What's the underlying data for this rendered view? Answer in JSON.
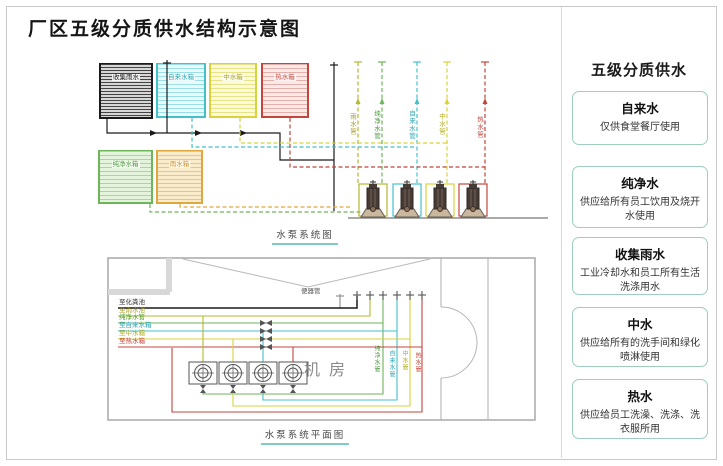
{
  "title": "厂区五级分质供水结构示意图",
  "system_diagram": {
    "caption": "水泵系统图",
    "tanks": [
      {
        "label": "收集雨水",
        "color": "#222222"
      },
      {
        "label": "自来水箱",
        "color": "#45c0cb"
      },
      {
        "label": "中水箱",
        "color": "#d9d23c"
      },
      {
        "label": "热水箱",
        "color": "#c4453c"
      },
      {
        "label": "纯净水箱",
        "color": "#6db45a"
      },
      {
        "label": "雨水箱",
        "color": "#dfa83e"
      }
    ],
    "pipe_labels": [
      "雨水管",
      "纯净水管",
      "自来水管",
      "中水管",
      "热水管"
    ]
  },
  "plan_diagram": {
    "caption": "水泵系统平面图",
    "room_label": "机房",
    "left_pipe_labels": [
      "至化粪池",
      "至雨水池",
      "纯净水管",
      "至自来水箱",
      "至中水箱",
      "至热水箱"
    ],
    "top_pipe_label": "便器管",
    "riser_labels": [
      "纯净水管",
      "自来水管",
      "中水管",
      "热水管"
    ]
  },
  "sidebar": {
    "title": "五级分质供水",
    "items": [
      {
        "name": "自来水",
        "desc": "仅供食堂餐厅使用"
      },
      {
        "name": "纯净水",
        "desc": "供应给所有员工饮用及烧开水使用"
      },
      {
        "name": "收集雨水",
        "desc": "工业冷却水和员工所有生活洗涤用水"
      },
      {
        "name": "中水",
        "desc": "供应给所有的洗手间和绿化喷淋使用"
      },
      {
        "name": "热水",
        "desc": "供应给员工洗澡、洗涤、洗衣服所用"
      }
    ]
  },
  "colors": {
    "accent_teal": "#7fccc4",
    "box_border": "#9dcfbc",
    "tap": "#45c0cb",
    "pure": "#6db45a",
    "rain": "#b5b832",
    "reclaimed": "#d9d23c",
    "hot": "#c4453c",
    "drain": "#1a1a1a"
  }
}
